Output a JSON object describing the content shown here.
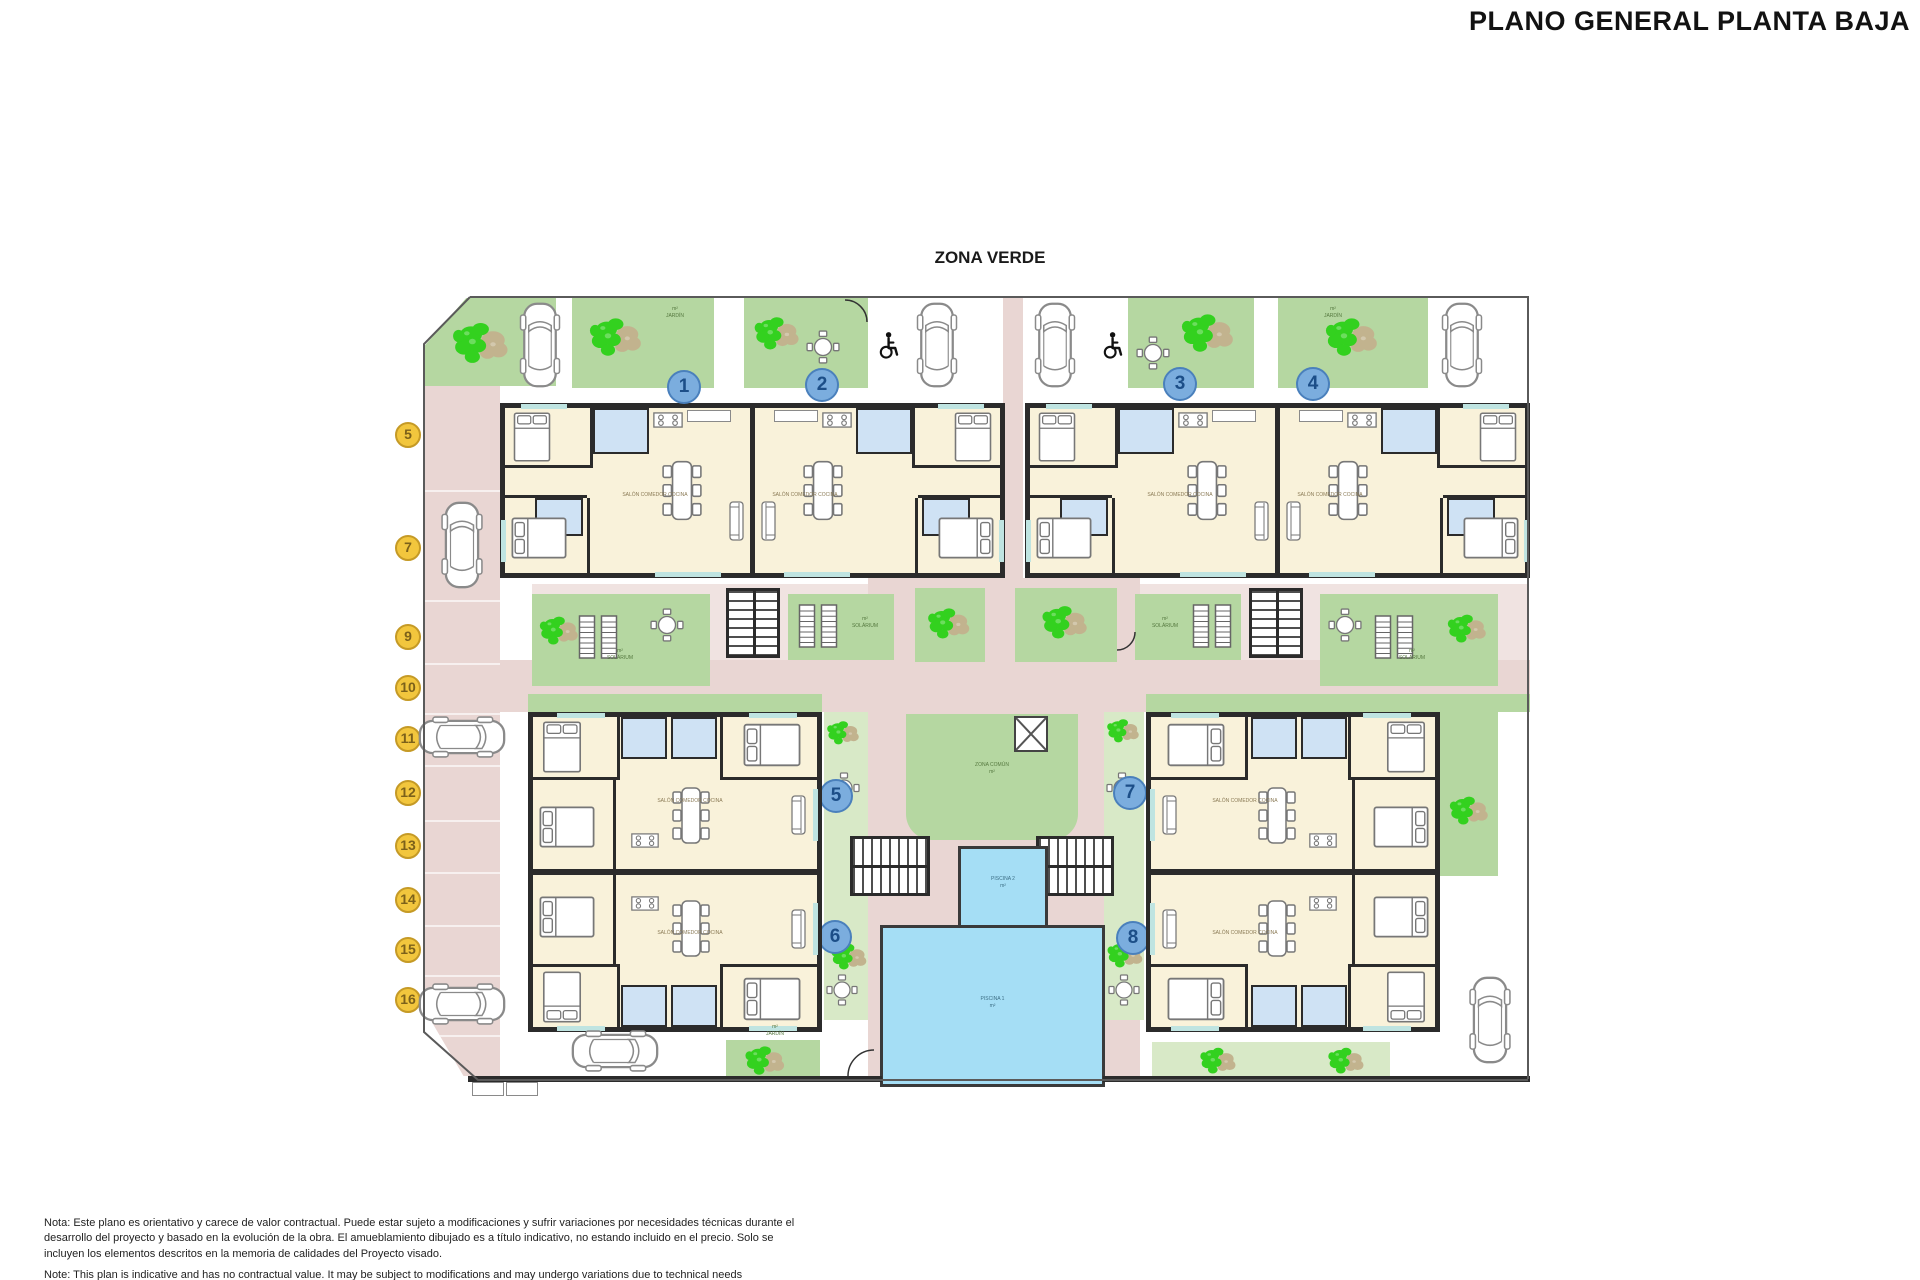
{
  "header": {
    "title": "PLANO GENERAL PLANTA BAJA"
  },
  "plan": {
    "zone_label": "ZONA VERDE",
    "unit_markers": [
      {
        "label": "1"
      },
      {
        "label": "2"
      },
      {
        "label": "3"
      },
      {
        "label": "4"
      },
      {
        "label": "5"
      },
      {
        "label": "6"
      },
      {
        "label": "7"
      },
      {
        "label": "8"
      }
    ],
    "parking_markers": [
      {
        "label": "5"
      },
      {
        "label": "7"
      },
      {
        "label": "9"
      },
      {
        "label": "10"
      },
      {
        "label": "11"
      },
      {
        "label": "12"
      },
      {
        "label": "13"
      },
      {
        "label": "14"
      },
      {
        "label": "15"
      },
      {
        "label": "16"
      }
    ],
    "room_labels": {
      "living": "SALÓN COMEDOR COCINA",
      "garden": "JARDÍN",
      "solarium": "SOLÁRIUM",
      "common_zone": "ZONA COMÚN",
      "pool1": "PISCINA 1",
      "pool2": "PISCINA 2",
      "area_unit": "m²"
    },
    "icons": {
      "car": "car-icon",
      "plant": "plant-icon",
      "round_table": "table-chairs-icon",
      "dining_table": "dining-table-icon",
      "bed": "bed-icon",
      "sofa": "sofa-icon",
      "stove": "stove-icon",
      "lounger": "sun-lounger-icon",
      "wheelchair": "wheelchair-icon",
      "stairs": "stairs-icon",
      "elevator": "elevator-x-icon"
    },
    "colors": {
      "garden_green": "#b5d7a1",
      "pale_green": "#d8e9c7",
      "path_pink": "#e9d6d3",
      "floor_cream": "#f9f2da",
      "bath_blue": "#cfe2f4",
      "pool_blue": "#a5def5",
      "wall_dark": "#2b2b2b",
      "marker_blue": "#7badde",
      "marker_yellow": "#f2c63d",
      "plant_green": "#33d11f",
      "plant_tan": "#c2b38e"
    }
  },
  "notes": {
    "es": "Nota: Este plano es orientativo y carece de valor contractual. Puede estar sujeto a modificaciones y sufrir variaciones por necesidades técnicas durante el desarrollo del proyecto y basado en la evolución de la obra. El amueblamiento dibujado es a título indicativo, no estando incluido en el precio. Solo se incluyen los elementos descritos en la memoria de calidades del Proyecto visado.",
    "en": "Note: This plan is indicative and has no contractual value. It may be subject to modifications and may undergo variations due to technical needs"
  }
}
